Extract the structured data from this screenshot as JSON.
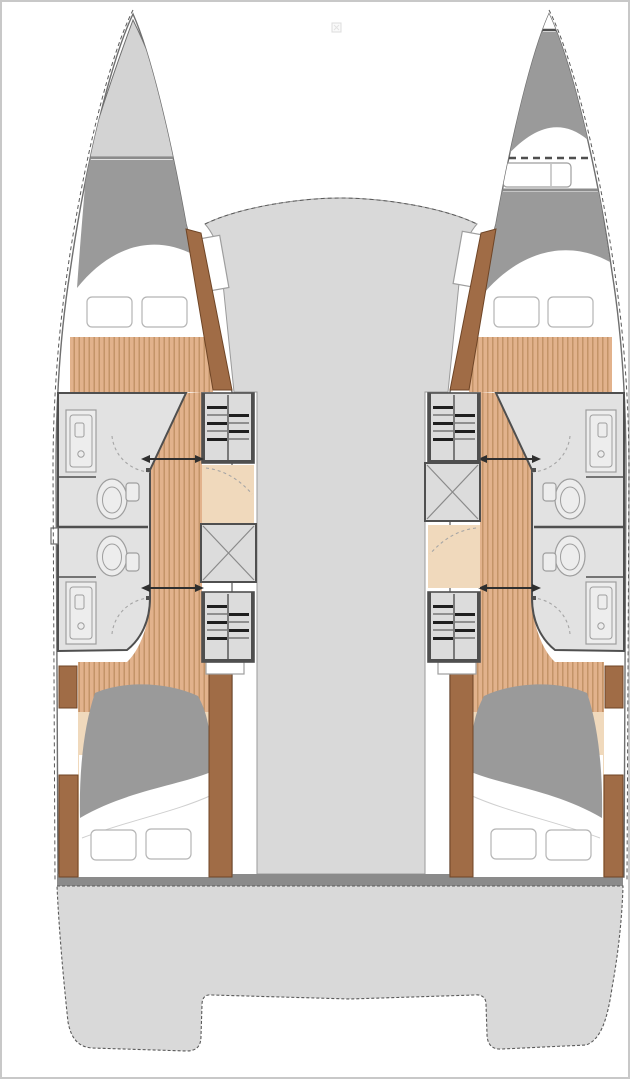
{
  "document": {
    "title": "Catamaran deck layout plan",
    "description": "Top-down naval-architecture style floor plan of a four-cabin sailing catamaran with two hulls, central bridge deck and aft swim platform"
  },
  "colors": {
    "background": "#ffffff",
    "frame": "#c8c8c8",
    "line": "#6f6f6f",
    "lineSoft": "#9a9a9a",
    "dash": "#5a5a5a",
    "deckLight": "#d3d3d3",
    "deckMid": "#d9d9d9",
    "berthGray": "#9a9a9a",
    "beamGray": "#8b8b8b",
    "roomGray": "#e2e2e2",
    "wall": "#4f4f4f",
    "fixtureFill": "#ededed",
    "fixtureLine": "#9e9e9e",
    "woodBase": "#e2b28c",
    "woodStripe": "#bc8c60",
    "woodBrown": "#a06c46",
    "woodBrownDark": "#6f4526",
    "landingTan": "#f0d9bc",
    "stairGray": "#dcdcdc",
    "stepDark": "#1f1f1f",
    "stepLight": "#8f8f8f",
    "xLine": "#8a8a8a",
    "arrow": "#2f2f2f",
    "doorArc": "#a5a5a5"
  },
  "plan": {
    "type": "boat-floor-plan",
    "vessel": "sailing catamaran",
    "view": "overhead deck plan",
    "port_hull": {
      "areas": [
        {
          "name": "port-bow-deck"
        },
        {
          "name": "port-forward-cabin",
          "furniture": [
            "double-berth",
            "pillow",
            "pillow",
            "wardrobe",
            "wood-floor"
          ]
        },
        {
          "name": "port-forward-bathroom",
          "fixtures": [
            "shower",
            "toilet",
            "cistern",
            "door-swing"
          ]
        },
        {
          "name": "port-aft-bathroom",
          "fixtures": [
            "shower",
            "toilet",
            "cistern",
            "door-swing"
          ]
        },
        {
          "name": "port-forward-companionway",
          "elements": [
            "steps"
          ]
        },
        {
          "name": "port-landing",
          "elements": [
            "tan-floor"
          ]
        },
        {
          "name": "port-storage-locker",
          "marker": "x-cross",
          "border": "solid"
        },
        {
          "name": "port-aft-companionway",
          "elements": [
            "steps"
          ]
        },
        {
          "name": "port-aft-cabin",
          "furniture": [
            "double-berth",
            "pillow",
            "pillow",
            "wardrobe",
            "wardrobe",
            "wood-floor"
          ]
        }
      ]
    },
    "starboard_hull": {
      "areas": [
        {
          "name": "starboard-bow-crew-berth",
          "furniture": [
            "single-berth",
            "deck-hatch"
          ]
        },
        {
          "name": "starboard-forward-cabin",
          "furniture": [
            "double-berth",
            "pillow",
            "pillow",
            "wardrobe",
            "wood-floor"
          ]
        },
        {
          "name": "starboard-forward-bathroom",
          "fixtures": [
            "shower",
            "toilet",
            "cistern",
            "door-swing"
          ]
        },
        {
          "name": "starboard-aft-bathroom",
          "fixtures": [
            "shower",
            "toilet",
            "cistern",
            "door-swing"
          ]
        },
        {
          "name": "starboard-forward-companionway",
          "elements": [
            "steps"
          ]
        },
        {
          "name": "starboard-storage-locker",
          "marker": "x-cross",
          "border": "dashed"
        },
        {
          "name": "starboard-landing",
          "elements": [
            "tan-floor"
          ]
        },
        {
          "name": "starboard-aft-companionway",
          "elements": [
            "steps"
          ]
        },
        {
          "name": "starboard-aft-cabin",
          "furniture": [
            "double-berth",
            "pillow",
            "pillow",
            "wardrobe",
            "wardrobe",
            "wood-floor"
          ]
        }
      ]
    },
    "bridge_deck": {
      "areas": [
        {
          "name": "coachroof-deck"
        },
        {
          "name": "port-deck-step"
        },
        {
          "name": "starboard-deck-step"
        }
      ]
    },
    "stern": {
      "areas": [
        {
          "name": "aft-crossbeam"
        },
        {
          "name": "aft-platform"
        },
        {
          "name": "port-transom"
        },
        {
          "name": "starboard-transom"
        }
      ]
    },
    "markers": [
      {
        "name": "door-threshold-arrow",
        "count": 4
      },
      {
        "name": "hull-fitting",
        "count": 1
      },
      {
        "name": "image-placeholder-glyph",
        "count": 1
      }
    ]
  }
}
